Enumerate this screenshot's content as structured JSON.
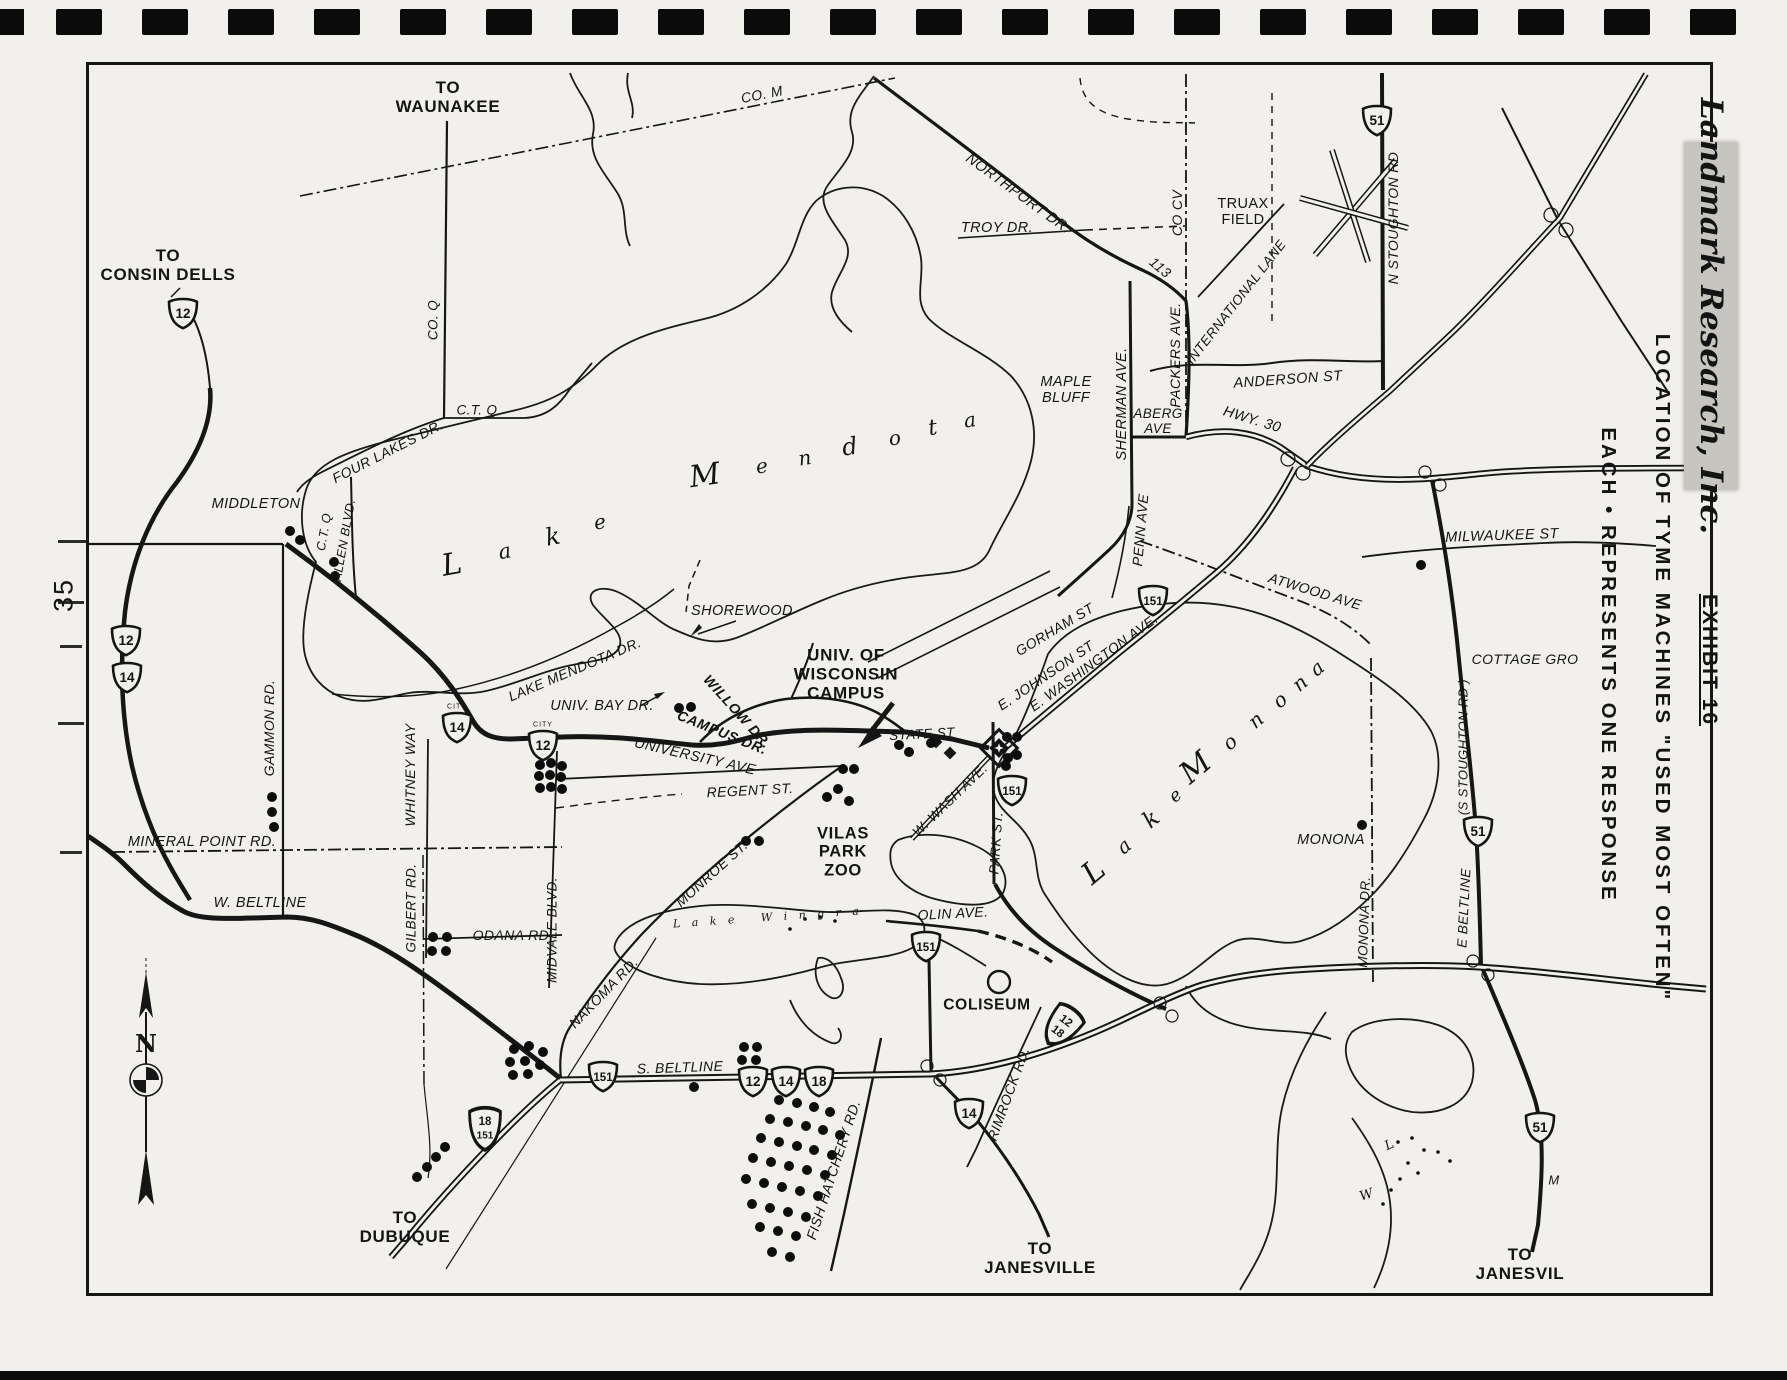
{
  "page": {
    "number": "35"
  },
  "margin": {
    "brand": "Landmark Research, Inc.",
    "exhibit": "EXHIBIT 16",
    "title": "LOCATION OF TYME MACHINES \"USED MOST OFTEN\"",
    "legend": "EACH • REPRESENTS ONE RESPONSE"
  },
  "compass": {
    "north": "N"
  },
  "map": {
    "labels": [
      {
        "t": "TO\nWAUNAKEE",
        "x": 448,
        "y": 97,
        "r": 0,
        "s": 17,
        "c": "b"
      },
      {
        "t": "TO\nCONSIN DELLS",
        "x": 168,
        "y": 265,
        "r": 0,
        "s": 17,
        "c": "b"
      },
      {
        "t": "CO. M",
        "x": 762,
        "y": 95,
        "r": -11,
        "s": 14,
        "c": "it"
      },
      {
        "t": "NORTHPORT DR.",
        "x": 1018,
        "y": 194,
        "r": 36,
        "s": 14.5,
        "c": "it"
      },
      {
        "t": "TROY DR.",
        "x": 997,
        "y": 228,
        "r": 0,
        "s": 14.5,
        "c": "it"
      },
      {
        "t": "CO CV",
        "x": 1178,
        "y": 213,
        "r": -90,
        "s": 14,
        "c": "it"
      },
      {
        "t": "TRUAX\nFIELD",
        "x": 1243,
        "y": 212,
        "r": 0,
        "s": 14.5,
        "c": ""
      },
      {
        "t": "INTERNATIONAL LANE",
        "x": 1236,
        "y": 302,
        "r": -52,
        "s": 13.5,
        "c": "it"
      },
      {
        "t": "N STOUGHTON RD",
        "x": 1394,
        "y": 218,
        "r": -90,
        "s": 14,
        "c": "it"
      },
      {
        "t": "PACKERS AVE.",
        "x": 1176,
        "y": 355,
        "r": -90,
        "s": 14,
        "c": "it"
      },
      {
        "t": "113",
        "x": 1160,
        "y": 268,
        "r": 40,
        "s": 14,
        "c": "it"
      },
      {
        "t": "ANDERSON ST",
        "x": 1288,
        "y": 380,
        "r": -4,
        "s": 14.5,
        "c": "it"
      },
      {
        "t": "MAPLE\nBLUFF",
        "x": 1066,
        "y": 390,
        "r": 0,
        "s": 14.5,
        "c": "it"
      },
      {
        "t": "SHERMAN AVE.",
        "x": 1122,
        "y": 404,
        "r": -90,
        "s": 14.5,
        "c": "it"
      },
      {
        "t": "ABERG\nAVE",
        "x": 1158,
        "y": 421,
        "r": 0,
        "s": 13.5,
        "c": "it"
      },
      {
        "t": "HWY. 30",
        "x": 1252,
        "y": 420,
        "r": 17,
        "s": 14.5,
        "c": "it"
      },
      {
        "t": "PENN AVE",
        "x": 1141,
        "y": 530,
        "r": -85,
        "s": 14,
        "c": "it"
      },
      {
        "t": "MILWAUKEE ST",
        "x": 1502,
        "y": 536,
        "r": -2,
        "s": 14.5,
        "c": "it"
      },
      {
        "t": "ATWOOD AVE",
        "x": 1315,
        "y": 592,
        "r": 17,
        "s": 14,
        "c": "it"
      },
      {
        "t": "COTTAGE GRO",
        "x": 1525,
        "y": 660,
        "r": 0,
        "s": 14,
        "c": "it"
      },
      {
        "t": "(S STOUGHTON RD )",
        "x": 1464,
        "y": 747,
        "r": -90,
        "s": 13,
        "c": "it"
      },
      {
        "t": "E BELTLINE",
        "x": 1464,
        "y": 908,
        "r": -87,
        "s": 13.5,
        "c": "it"
      },
      {
        "t": "MONONA",
        "x": 1331,
        "y": 840,
        "r": 0,
        "s": 14.5,
        "c": "it"
      },
      {
        "t": "MONONA DR.",
        "x": 1364,
        "y": 922,
        "r": -88,
        "s": 13.5,
        "c": "it"
      },
      {
        "t": "MIDDLETON",
        "x": 256,
        "y": 504,
        "r": 0,
        "s": 14.5,
        "c": "it"
      },
      {
        "t": "C.T. Q",
        "x": 477,
        "y": 410,
        "r": 0,
        "s": 13.5,
        "c": "it"
      },
      {
        "t": "CO. Q",
        "x": 433,
        "y": 320,
        "r": -90,
        "s": 13.5,
        "c": "it"
      },
      {
        "t": "FOUR LAKES DR.",
        "x": 388,
        "y": 452,
        "r": -27,
        "s": 14,
        "c": "it"
      },
      {
        "t": "C.T. Q",
        "x": 324,
        "y": 532,
        "r": -80,
        "s": 12.5,
        "c": "it"
      },
      {
        "t": "ALLEN BLVD.",
        "x": 344,
        "y": 540,
        "r": -80,
        "s": 12.5,
        "c": "it"
      },
      {
        "t": "GAMMON RD.",
        "x": 270,
        "y": 728,
        "r": -90,
        "s": 14,
        "c": "it"
      },
      {
        "t": "WHITNEY WAY",
        "x": 411,
        "y": 775,
        "r": -90,
        "s": 14,
        "c": "it"
      },
      {
        "t": "MINERAL POINT RD.",
        "x": 202,
        "y": 842,
        "r": 0,
        "s": 14.5,
        "c": "it"
      },
      {
        "t": "W. BELTLINE",
        "x": 260,
        "y": 903,
        "r": 0,
        "s": 14.5,
        "c": "it"
      },
      {
        "t": "GILBERT RD.",
        "x": 411,
        "y": 908,
        "r": -90,
        "s": 13.5,
        "c": "it"
      },
      {
        "t": "ODANA RD.",
        "x": 513,
        "y": 936,
        "r": 0,
        "s": 14,
        "c": "it"
      },
      {
        "t": "MIDVALE BLVD.",
        "x": 552,
        "y": 930,
        "r": -90,
        "s": 13.5,
        "c": "it"
      },
      {
        "t": "NAKOMA RD.",
        "x": 604,
        "y": 993,
        "r": -46,
        "s": 14,
        "c": "it"
      },
      {
        "t": "LAKE MENDOTA DR.",
        "x": 575,
        "y": 670,
        "r": -23,
        "s": 14,
        "c": "it"
      },
      {
        "t": "SHOREWOOD",
        "x": 742,
        "y": 611,
        "r": 0,
        "s": 14.5,
        "c": "it"
      },
      {
        "t": "UNIV. BAY DR.",
        "x": 602,
        "y": 706,
        "r": 0,
        "s": 14.5,
        "c": "it"
      },
      {
        "t": "WILLOW DR.",
        "x": 737,
        "y": 712,
        "r": 48,
        "s": 14,
        "c": "it b"
      },
      {
        "t": "CAMPUS DR.",
        "x": 722,
        "y": 733,
        "r": 22,
        "s": 14,
        "c": "it b"
      },
      {
        "t": "UNIVERSITY AVE",
        "x": 695,
        "y": 757,
        "r": 13,
        "s": 14.5,
        "c": "it"
      },
      {
        "t": "REGENT ST.",
        "x": 750,
        "y": 791,
        "r": -3,
        "s": 14,
        "c": "it"
      },
      {
        "t": "UNIV. OF\nWISCONSIN\nCAMPUS",
        "x": 846,
        "y": 674,
        "r": 0,
        "s": 17,
        "c": "b"
      },
      {
        "t": "STATE ST",
        "x": 922,
        "y": 734,
        "r": -3,
        "s": 13.5,
        "c": "it"
      },
      {
        "t": "MONROE ST.",
        "x": 712,
        "y": 874,
        "r": -42,
        "s": 14,
        "c": "it"
      },
      {
        "t": "VILAS\nPARK\nZOO",
        "x": 843,
        "y": 852,
        "r": 0,
        "s": 16.5,
        "c": "b"
      },
      {
        "t": "PARK ST.",
        "x": 996,
        "y": 843,
        "r": -86,
        "s": 13.5,
        "c": "it"
      },
      {
        "t": "W. WASH AVE.",
        "x": 950,
        "y": 800,
        "r": -44,
        "s": 13.5,
        "c": "it"
      },
      {
        "t": "GORHAM ST",
        "x": 1055,
        "y": 630,
        "r": -31,
        "s": 14,
        "c": "it"
      },
      {
        "t": "E. JOHNSON ST",
        "x": 1046,
        "y": 676,
        "r": -34,
        "s": 14,
        "c": "it"
      },
      {
        "t": "E. WASHINGTON AVE.",
        "x": 1094,
        "y": 663,
        "r": -36,
        "s": 14,
        "c": "it"
      },
      {
        "t": "OLIN AVE.",
        "x": 953,
        "y": 914,
        "r": -3,
        "s": 14,
        "c": "it"
      },
      {
        "t": "COLISEUM",
        "x": 987,
        "y": 1005,
        "r": 0,
        "s": 15.5,
        "c": "b"
      },
      {
        "t": "RIMROCK RD.",
        "x": 1009,
        "y": 1094,
        "r": -70,
        "s": 14,
        "c": "it"
      },
      {
        "t": "FISH HATCHERY RD.",
        "x": 834,
        "y": 1170,
        "r": -72,
        "s": 14,
        "c": "it"
      },
      {
        "t": "S. BELTLINE",
        "x": 680,
        "y": 1068,
        "r": -2,
        "s": 14,
        "c": "it"
      },
      {
        "t": "TO\nDUBUQUE",
        "x": 405,
        "y": 1227,
        "r": 0,
        "s": 17,
        "c": "b"
      },
      {
        "t": "TO\nJANESVILLE",
        "x": 1040,
        "y": 1258,
        "r": 0,
        "s": 17,
        "c": "b"
      },
      {
        "t": "TO\nJANESVIL",
        "x": 1520,
        "y": 1264,
        "r": 0,
        "s": 17,
        "c": "b"
      },
      {
        "t": "M",
        "x": 1554,
        "y": 1181,
        "r": 0,
        "s": 13,
        "c": "it"
      },
      {
        "t": "L a k e   W i n g r a",
        "x": 768,
        "y": 918,
        "r": -4,
        "s": 11,
        "c": "sc",
        "ls": 4
      }
    ],
    "scripts": [
      {
        "t": "L",
        "x": 452,
        "y": 565,
        "r": -10,
        "s": 30
      },
      {
        "t": "a",
        "x": 505,
        "y": 552,
        "r": -10,
        "s": 21
      },
      {
        "t": "k",
        "x": 553,
        "y": 537,
        "r": -10,
        "s": 24
      },
      {
        "t": "e",
        "x": 600,
        "y": 522,
        "r": -10,
        "s": 20
      },
      {
        "t": "M",
        "x": 705,
        "y": 476,
        "r": -8,
        "s": 30
      },
      {
        "t": "e",
        "x": 762,
        "y": 466,
        "r": -8,
        "s": 20
      },
      {
        "t": "n",
        "x": 805,
        "y": 458,
        "r": -8,
        "s": 20
      },
      {
        "t": "d",
        "x": 850,
        "y": 447,
        "r": -8,
        "s": 24
      },
      {
        "t": "o",
        "x": 895,
        "y": 438,
        "r": -8,
        "s": 20
      },
      {
        "t": "t",
        "x": 933,
        "y": 429,
        "r": -8,
        "s": 22
      },
      {
        "t": "a",
        "x": 970,
        "y": 420,
        "r": -8,
        "s": 20
      },
      {
        "t": "L",
        "x": 1094,
        "y": 872,
        "r": -40,
        "s": 30
      },
      {
        "t": "a",
        "x": 1124,
        "y": 846,
        "r": -40,
        "s": 20
      },
      {
        "t": "k",
        "x": 1152,
        "y": 820,
        "r": -40,
        "s": 23
      },
      {
        "t": "e",
        "x": 1176,
        "y": 796,
        "r": -40,
        "s": 18
      },
      {
        "t": "M",
        "x": 1196,
        "y": 768,
        "r": -40,
        "s": 30
      },
      {
        "t": "o",
        "x": 1230,
        "y": 742,
        "r": -40,
        "s": 20
      },
      {
        "t": "n",
        "x": 1256,
        "y": 720,
        "r": -40,
        "s": 20
      },
      {
        "t": "o",
        "x": 1280,
        "y": 700,
        "r": -40,
        "s": 20
      },
      {
        "t": "n",
        "x": 1300,
        "y": 683,
        "r": -40,
        "s": 20
      },
      {
        "t": "a",
        "x": 1317,
        "y": 668,
        "r": -40,
        "s": 20
      },
      {
        "t": "L",
        "x": 1390,
        "y": 1146,
        "r": -25,
        "s": 13
      },
      {
        "t": "W",
        "x": 1367,
        "y": 1196,
        "r": -18,
        "s": 13
      }
    ],
    "shields": [
      {
        "x": 183,
        "y": 313,
        "label": "12"
      },
      {
        "x": 126,
        "y": 640,
        "label": "12"
      },
      {
        "x": 127,
        "y": 677,
        "label": "14"
      },
      {
        "x": 457,
        "y": 727,
        "label": "14",
        "city": true
      },
      {
        "x": 543,
        "y": 745,
        "label": "12",
        "city": true
      },
      {
        "x": 1377,
        "y": 120,
        "label": "51"
      },
      {
        "x": 1153,
        "y": 600,
        "label": "151"
      },
      {
        "x": 1012,
        "y": 790,
        "label": "151"
      },
      {
        "x": 926,
        "y": 946,
        "label": "151"
      },
      {
        "x": 603,
        "y": 1076,
        "label": "151"
      },
      {
        "x": 485,
        "y": 1128,
        "label": "18",
        "stack": "151"
      },
      {
        "x": 753,
        "y": 1081,
        "label": "12"
      },
      {
        "x": 786,
        "y": 1081,
        "label": "14"
      },
      {
        "x": 819,
        "y": 1081,
        "label": "18"
      },
      {
        "x": 969,
        "y": 1113,
        "label": "14"
      },
      {
        "x": 1478,
        "y": 831,
        "label": "51"
      },
      {
        "x": 1540,
        "y": 1127,
        "label": "51"
      },
      {
        "x": 1062,
        "y": 1026,
        "label": "12",
        "stack": "18",
        "rot": 38
      }
    ],
    "dots": [
      [
        290,
        531
      ],
      [
        300,
        540
      ],
      [
        334,
        562
      ],
      [
        335,
        576
      ],
      [
        272,
        797
      ],
      [
        272,
        812
      ],
      [
        274,
        827
      ],
      [
        433,
        937
      ],
      [
        447,
        937
      ],
      [
        432,
        951
      ],
      [
        446,
        951
      ],
      [
        540,
        765
      ],
      [
        551,
        763
      ],
      [
        562,
        766
      ],
      [
        539,
        776
      ],
      [
        550,
        775
      ],
      [
        561,
        777
      ],
      [
        540,
        788
      ],
      [
        551,
        787
      ],
      [
        562,
        789
      ],
      [
        679,
        708
      ],
      [
        691,
        707
      ],
      [
        746,
        841
      ],
      [
        759,
        841
      ],
      [
        843,
        769
      ],
      [
        854,
        769
      ],
      [
        838,
        789
      ],
      [
        827,
        797
      ],
      [
        849,
        801
      ],
      [
        899,
        745
      ],
      [
        909,
        752
      ],
      [
        931,
        743
      ],
      [
        1007,
        737
      ],
      [
        1017,
        737
      ],
      [
        1008,
        758
      ],
      [
        1017,
        755
      ],
      [
        1006,
        766
      ],
      [
        1421,
        565
      ],
      [
        1362,
        825
      ],
      [
        417,
        1177
      ],
      [
        427,
        1167
      ],
      [
        436,
        1157
      ],
      [
        445,
        1147
      ],
      [
        514,
        1049
      ],
      [
        529,
        1046
      ],
      [
        543,
        1052
      ],
      [
        510,
        1062
      ],
      [
        525,
        1061
      ],
      [
        540,
        1065
      ],
      [
        513,
        1075
      ],
      [
        528,
        1074
      ],
      [
        744,
        1047
      ],
      [
        757,
        1047
      ],
      [
        742,
        1060
      ],
      [
        756,
        1060
      ],
      [
        744,
        1072
      ],
      [
        694,
        1087
      ],
      [
        779,
        1100
      ],
      [
        797,
        1103
      ],
      [
        814,
        1107
      ],
      [
        830,
        1112
      ],
      [
        770,
        1119
      ],
      [
        788,
        1122
      ],
      [
        806,
        1126
      ],
      [
        823,
        1130
      ],
      [
        840,
        1135
      ],
      [
        761,
        1138
      ],
      [
        779,
        1142
      ],
      [
        797,
        1146
      ],
      [
        814,
        1150
      ],
      [
        832,
        1155
      ],
      [
        753,
        1158
      ],
      [
        771,
        1162
      ],
      [
        789,
        1166
      ],
      [
        807,
        1170
      ],
      [
        825,
        1175
      ],
      [
        746,
        1179
      ],
      [
        764,
        1183
      ],
      [
        782,
        1187
      ],
      [
        800,
        1191
      ],
      [
        818,
        1196
      ],
      [
        752,
        1204
      ],
      [
        770,
        1208
      ],
      [
        788,
        1212
      ],
      [
        806,
        1217
      ],
      [
        760,
        1227
      ],
      [
        778,
        1231
      ],
      [
        796,
        1236
      ],
      [
        772,
        1252
      ],
      [
        790,
        1257
      ]
    ],
    "specks": [
      [
        1398,
        1142
      ],
      [
        1412,
        1138
      ],
      [
        1424,
        1150
      ],
      [
        1438,
        1152
      ],
      [
        1450,
        1161
      ],
      [
        1408,
        1163
      ],
      [
        1418,
        1173
      ],
      [
        1400,
        1179
      ],
      [
        1391,
        1190
      ],
      [
        1383,
        1204
      ],
      [
        805,
        919
      ],
      [
        820,
        917
      ],
      [
        835,
        921
      ],
      [
        790,
        929
      ]
    ]
  }
}
